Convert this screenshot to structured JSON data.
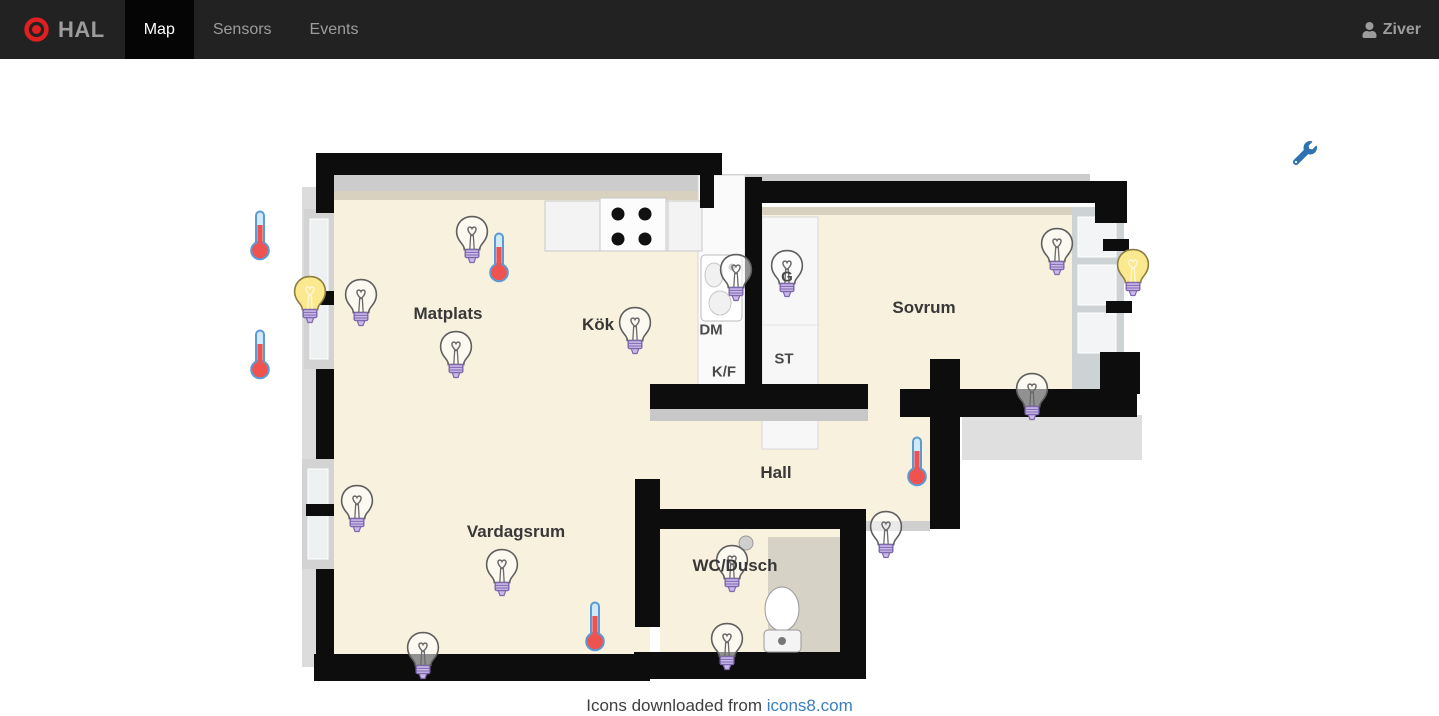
{
  "navbar": {
    "brand": "HAL",
    "tabs": [
      {
        "label": "Map",
        "active": true
      },
      {
        "label": "Sensors",
        "active": false
      },
      {
        "label": "Events",
        "active": false
      }
    ],
    "user": "Ziver"
  },
  "map": {
    "rooms": [
      {
        "name": "Matplats",
        "x": 148,
        "y": 167,
        "size": "lg"
      },
      {
        "name": "Kök",
        "x": 298,
        "y": 178,
        "size": "lg"
      },
      {
        "name": "Sovrum",
        "x": 624,
        "y": 161,
        "size": "lg"
      },
      {
        "name": "Hall",
        "x": 476,
        "y": 326,
        "size": "lg"
      },
      {
        "name": "Vardagsrum",
        "x": 216,
        "y": 385,
        "size": "lg"
      },
      {
        "name": "WC/Dusch",
        "x": 435,
        "y": 419,
        "size": "lg"
      },
      {
        "name": "DM",
        "x": 411,
        "y": 183,
        "size": "sm"
      },
      {
        "name": "K/F",
        "x": 424,
        "y": 225,
        "size": "sm"
      },
      {
        "name": "ST",
        "x": 484,
        "y": 212,
        "size": "sm"
      },
      {
        "name": "G",
        "x": 487,
        "y": 130,
        "size": "sm"
      }
    ],
    "sensors": [
      {
        "id": "matplats-ceiling",
        "type": "bulb",
        "state": "off",
        "x": 172,
        "y": 93
      },
      {
        "id": "matplats-bay",
        "type": "bulb",
        "state": "on",
        "x": 10,
        "y": 153
      },
      {
        "id": "matplats-window",
        "type": "bulb",
        "state": "off",
        "x": 61,
        "y": 156
      },
      {
        "id": "matplats-table",
        "type": "bulb",
        "state": "off",
        "x": 156,
        "y": 208
      },
      {
        "id": "kok",
        "type": "bulb",
        "state": "off",
        "x": 335,
        "y": 184
      },
      {
        "id": "kok-sink",
        "type": "bulb",
        "state": "off",
        "x": 436,
        "y": 131
      },
      {
        "id": "closet-g",
        "type": "bulb",
        "state": "off",
        "x": 487,
        "y": 127
      },
      {
        "id": "sovrum-window",
        "type": "bulb",
        "state": "off",
        "x": 757,
        "y": 105
      },
      {
        "id": "sovrum-bay",
        "type": "bulb",
        "state": "on",
        "x": 833,
        "y": 126
      },
      {
        "id": "sovrum-south",
        "type": "bulb",
        "state": "off",
        "x": 732,
        "y": 250
      },
      {
        "id": "hall",
        "type": "bulb",
        "state": "off",
        "x": 586,
        "y": 388
      },
      {
        "id": "vardagsrum-window",
        "type": "bulb",
        "state": "off",
        "x": 57,
        "y": 362
      },
      {
        "id": "vardagsrum-ceiling",
        "type": "bulb",
        "state": "off",
        "x": 202,
        "y": 426
      },
      {
        "id": "vardagsrum-balcony",
        "type": "bulb",
        "state": "off",
        "x": 123,
        "y": 509
      },
      {
        "id": "wc-ceiling",
        "type": "bulb",
        "state": "off",
        "x": 432,
        "y": 422
      },
      {
        "id": "wc-mirror",
        "type": "bulb",
        "state": "off",
        "x": 427,
        "y": 500
      },
      {
        "id": "outdoor-north",
        "type": "thermometer",
        "state": "",
        "x": -40,
        "y": 88
      },
      {
        "id": "outdoor-south",
        "type": "thermometer",
        "state": "",
        "x": -40,
        "y": 207
      },
      {
        "id": "matplats",
        "type": "thermometer",
        "state": "",
        "x": 199,
        "y": 110
      },
      {
        "id": "hall-wall",
        "type": "thermometer",
        "state": "",
        "x": 617,
        "y": 314
      },
      {
        "id": "vardagsrum",
        "type": "thermometer",
        "state": "",
        "x": 295,
        "y": 479
      }
    ]
  },
  "footer": {
    "text": "Icons downloaded from ",
    "link": "icons8.com"
  },
  "colors": {
    "nav_bg": "#222222",
    "nav_active": "#050505",
    "brand_red": "#e02020",
    "accent_blue": "#2e73b0",
    "bulb_on_fill": "#fbe98f",
    "bulb_on_stroke": "#8d7d40",
    "bulb_off_stroke": "#5f5f5f",
    "bulb_base": "#cbb9e8",
    "bulb_base_stroke": "#7e68ae",
    "thermo_fluid": "#ef5350",
    "thermo_tube": "#cfe9f8",
    "thermo_stroke": "#5b9bd5",
    "floor_beige": "#f8f1de",
    "wall_black": "#0d0d0d"
  }
}
